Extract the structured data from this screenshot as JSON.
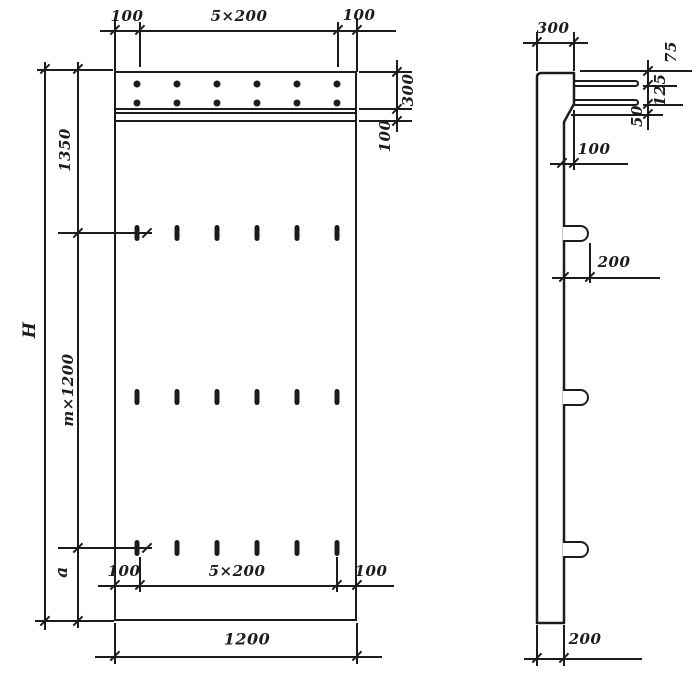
{
  "drawing": {
    "kind": "reinforced concrete panel working drawing, front view and side section",
    "ink_color": "#1c1c1c",
    "paper_color": "#ffffff",
    "front": {
      "top": {
        "left_margin": "100",
        "spacing": "5×200",
        "right_margin": "100"
      },
      "right": {
        "strip_height": "300",
        "band_height": "100"
      },
      "left": {
        "upper": "1350",
        "overall_height": "H",
        "module": "m×1200",
        "lower": "a"
      },
      "bottom": {
        "left_margin": "100",
        "spacing": "5×200",
        "right_margin": "100",
        "overall_width": "1200"
      }
    },
    "side": {
      "top_width": "300",
      "bar_offsets": {
        "top": "75",
        "between": "125",
        "below": "50"
      },
      "step": "100",
      "loop_length": "200",
      "bottom_thickness": "200"
    },
    "features": {
      "anchor_dots": {
        "rows": 2,
        "cols": 6
      },
      "slots": {
        "rows": 3,
        "cols": 6
      },
      "loops": 3,
      "top_bars": 2
    }
  }
}
